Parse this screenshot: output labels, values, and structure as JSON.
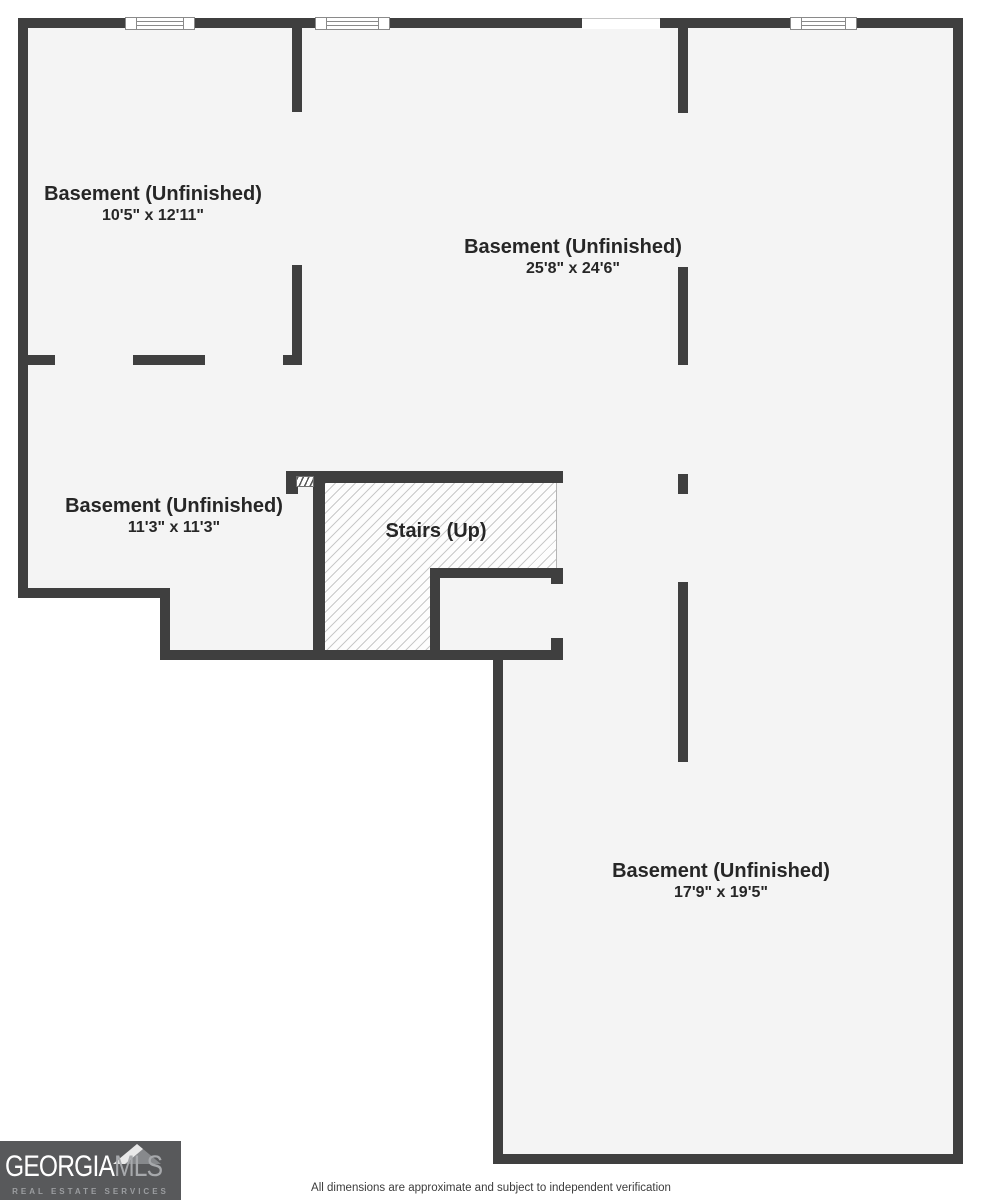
{
  "colors": {
    "wall": "#3f3f3f",
    "floor": "#f4f4f4",
    "hatch_line": "#c9c9c9",
    "logo_bg": "#58595b",
    "logo_secondary": "#a7a9ac"
  },
  "rooms": [
    {
      "name": "Basement (Unfinished)",
      "dims": "10'5\" x 12'11\""
    },
    {
      "name": "Basement (Unfinished)",
      "dims": "25'8\" x 24'6\""
    },
    {
      "name": "Basement (Unfinished)",
      "dims": "11'3\" x 11'3\""
    },
    {
      "name": "Basement (Unfinished)",
      "dims": "17'9\" x 19'5\""
    }
  ],
  "stairs": {
    "label": "Stairs (Up)"
  },
  "footer": {
    "disclaimer": "All dimensions are approximate and subject to independent verification"
  },
  "logo": {
    "brand_primary": "GEORGIA",
    "brand_secondary": "MLS",
    "tagline": "REAL ESTATE SERVICES"
  }
}
